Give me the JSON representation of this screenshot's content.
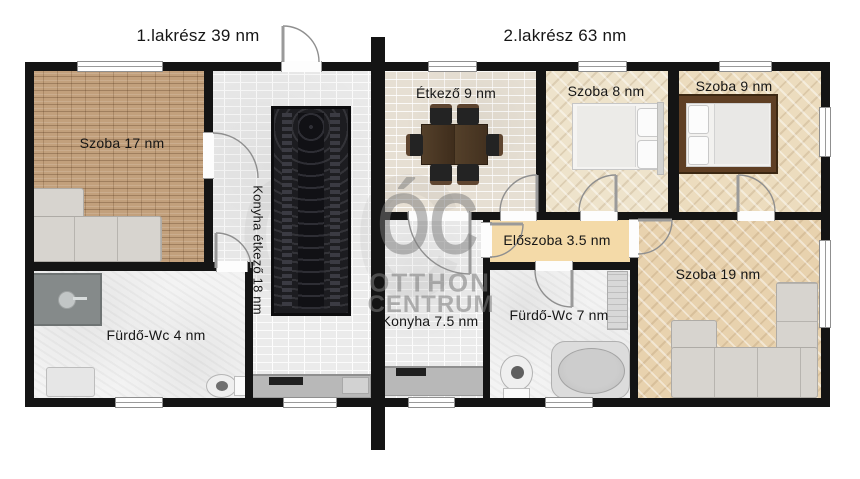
{
  "plan_title": "Kétlakrészes családi ház alaprajz",
  "units": {
    "u1": {
      "label": "1.lakrész 39 nm"
    },
    "u2": {
      "label": "2.lakrész 63 nm"
    }
  },
  "rooms": {
    "szoba17": {
      "label": "Szoba 17 nm"
    },
    "konyhaEtkezo": {
      "label": "Konyha étkező 18 nm"
    },
    "furdo4": {
      "label": "Fürdő-Wc 4 nm"
    },
    "etkezo": {
      "label": "Étkező 9 nm"
    },
    "konyha75": {
      "label": "Konyha 7.5 nm"
    },
    "szoba8": {
      "label": "Szoba 8 nm"
    },
    "szoba9": {
      "label": "Szoba 9 nm"
    },
    "eloszoba": {
      "label": "Előszoba 3.5 nm"
    },
    "furdo7": {
      "label": "Fürdő-Wc 7 nm"
    },
    "szoba19": {
      "label": "Szoba 19 nm"
    }
  },
  "watermark": {
    "monogram": "ÓC",
    "line1": "OTTHON",
    "line2": "CENTRUM"
  },
  "colors": {
    "wall": "#141414",
    "brick": "#c2a07c",
    "tile": "#ebebeb",
    "tileWarm": "#e6dfd3",
    "woodLight": "#eee3cb",
    "woodMid": "#ecdcbe",
    "woodTan": "#e8d2ae",
    "bath": "#f3f3f3",
    "hall": "#f4daa8",
    "rug": "#1c1c20",
    "counter": "#b8b8b8",
    "sofa": "#d7d4cf",
    "tableWood": "#4a3423",
    "chair": "#232323",
    "bedFrame": "#5f3f24",
    "watermark": "#7a7a7a",
    "doorArc": "#8f8f8f"
  }
}
